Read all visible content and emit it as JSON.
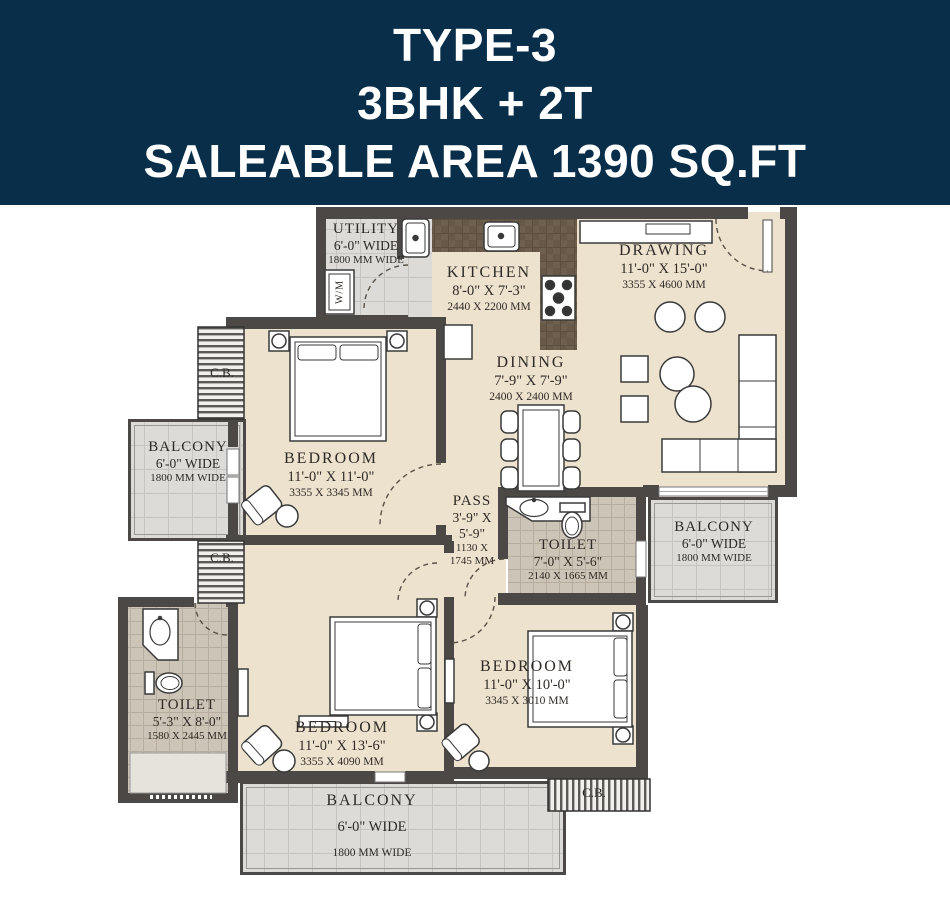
{
  "header": {
    "line1": "TYPE-3",
    "line2": "3BHK + 2T",
    "line3": "SALEABLE AREA 1390 SQ.FT"
  },
  "rooms": {
    "utility": {
      "name": "UTILITY",
      "size_ft": "6'-0\" WIDE",
      "size_mm": "1800 MM WIDE"
    },
    "kitchen": {
      "name": "KITCHEN",
      "size_ft": "8'-0\" X 7'-3\"",
      "size_mm": "2440 X 2200 MM"
    },
    "drawing": {
      "name": "DRAWING",
      "size_ft": "11'-0\" X 15'-0\"",
      "size_mm": "3355 X 4600 MM"
    },
    "dining": {
      "name": "DINING",
      "size_ft": "7'-9\" X 7'-9\"",
      "size_mm": "2400 X 2400 MM"
    },
    "bedroom_top": {
      "name": "BEDROOM",
      "size_ft": "11'-0\" X 11'-0\"",
      "size_mm": "3355 X 3345 MM"
    },
    "bedroom_middle": {
      "name": "BEDROOM",
      "size_ft": "11'-0\" X 13'-6\"",
      "size_mm": "3355 X 4090 MM"
    },
    "bedroom_right": {
      "name": "BEDROOM",
      "size_ft": "11'-0\" X 10'-0\"",
      "size_mm": "3345 X 3010 MM"
    },
    "toilet_mid": {
      "name": "TOILET",
      "size_ft": "7'-0\" X 5'-6\"",
      "size_mm": "2140 X 1665 MM"
    },
    "toilet_left": {
      "name": "TOILET",
      "size_ft": "5'-3\" X 8'-0\"",
      "size_mm": "1580 X 2445 MM"
    },
    "balcony_left": {
      "name": "BALCONY",
      "size_ft": "6'-0\" WIDE",
      "size_mm": "1800 MM WIDE"
    },
    "balcony_right": {
      "name": "BALCONY",
      "size_ft": "6'-0\" WIDE",
      "size_mm": "1800 MM WIDE"
    },
    "balcony_bottom": {
      "name": "BALCONY",
      "size_ft": "6'-0\" WIDE",
      "size_mm": "1800 MM WIDE"
    },
    "pass": {
      "name": "PASS",
      "l1": "3'-9\" X",
      "l2": "5'-9\"",
      "l3": "1130 X",
      "l4": "1745 MM"
    }
  },
  "labels": {
    "cupboard": "C.B.",
    "washing_machine": "W/M"
  },
  "colors": {
    "header_bg": "#082e4a",
    "header_text": "#ffffff",
    "wall": "#4b4845",
    "floor_beige": "#ece2cd",
    "floor_tile": "#dcdbd7",
    "floor_toilet": "#ccc5b7",
    "counter_brown": "#6e5f4f",
    "label_text": "#2e2a26"
  }
}
